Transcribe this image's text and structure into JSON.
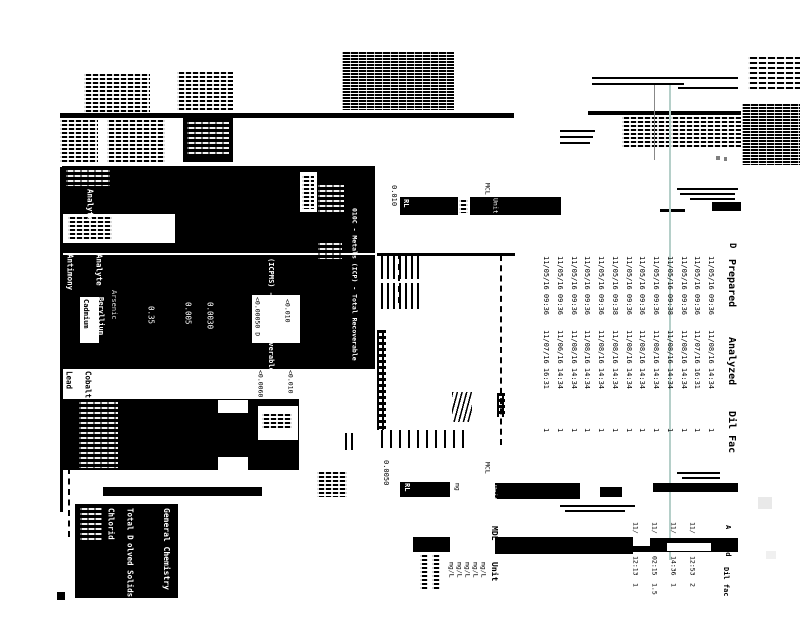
{
  "metals": {
    "title_icp": "010C - Metals (ICP) - Total Recoverable",
    "title_icpms": "(ICPMS) - Total Recoverable",
    "analyte_header": "Analyte",
    "analyte_header_2": "Analyte",
    "analytes": {
      "antimony": "Antimony",
      "arsenic": "Arsenic",
      "beryllium": "Beryllium",
      "cadmium": "Cadmium",
      "cobalt": "Cobalt",
      "lead": "Lead"
    },
    "results": {
      "r1": "0.35",
      "r2": "0.005",
      "r3": "0.0030",
      "r4": "<0.00050 D",
      "r5": "<0.010",
      "r6": "<0.0060",
      "r7": "<0.010"
    },
    "header_row": {
      "rl_value": "0.010",
      "rl": "RL",
      "mcl": "MCL",
      "unit": "Unit"
    }
  },
  "prep_table": {
    "headers": {
      "d": "D",
      "prepared": "Prepared",
      "analyzed": "Analyzed",
      "dil_fac": "Dil Fac"
    },
    "rows": [
      {
        "prepared": "11/05/16 09:36",
        "analyzed": "11/08/16 14:34",
        "dil_fac": "1"
      },
      {
        "prepared": "11/05/16 09:36",
        "analyzed": "11/07/16 16:31",
        "dil_fac": "1"
      },
      {
        "prepared": "11/05/16 09:36",
        "analyzed": "11/08/16 14:34",
        "dil_fac": "1"
      },
      {
        "prepared": "11/05/16 09:38",
        "analyzed": "11/08/16 14:34",
        "dil_fac": "1"
      },
      {
        "prepared": "11/05/16 09:36",
        "analyzed": "11/08/16 14:34",
        "dil_fac": "1"
      },
      {
        "prepared": "11/05/16 09:36",
        "analyzed": "11/08/16 14:34",
        "dil_fac": "1"
      },
      {
        "prepared": "11/05/16 09:36",
        "analyzed": "11/08/16 14:34",
        "dil_fac": "1"
      },
      {
        "prepared": "11/05/16 09:38",
        "analyzed": "11/08/16 14:34",
        "dil_fac": "1"
      },
      {
        "prepared": "11/05/16 09:36",
        "analyzed": "11/08/16 14:34",
        "dil_fac": "1"
      },
      {
        "prepared": "11/05/16 09:36",
        "analyzed": "11/08/16 14:34",
        "dil_fac": "1"
      },
      {
        "prepared": "11/05/16 09:36",
        "analyzed": "11/08/16 14:34",
        "dil_fac": "1"
      },
      {
        "prepared": "11/05/16 09:36",
        "analyzed": "11/06/16 14:34",
        "dil_fac": "1"
      },
      {
        "prepared": "11/05/16 09:36",
        "analyzed": "11/07/16 16:31",
        "dil_fac": "1"
      }
    ]
  },
  "bottom_header": {
    "rl_value": "0.0050",
    "rl": "RL",
    "mg": "mg",
    "mcl": "MCL",
    "unit": "Unit"
  },
  "gc_table": {
    "mdl": "MDL",
    "unit": "Unit",
    "units": [
      "mg/L",
      "mg/L",
      "mg/L",
      "mg/L",
      "mg/L"
    ],
    "section": "General Chemistry",
    "analyte_fragments": {
      "tds_a": "Total D",
      "tds_b": "olved Solids",
      "chloride": "Chlorid"
    }
  },
  "mini_table": {
    "headers": {
      "analyzed_frag": "A",
      "prepared_frag": "ed",
      "dil_fac": "Dil fac"
    },
    "rows": [
      {
        "frag": "11/",
        "time": "12:53",
        "dil": "2"
      },
      {
        "frag": "11/",
        "time": "14:36",
        "dil": "1"
      },
      {
        "frag": "11/",
        "time": "02:15",
        "dil": "1.5"
      },
      {
        "frag": "11/",
        "time": "12:13",
        "dil": "1"
      }
    ]
  },
  "artifact_line_color": "#b5cfc9"
}
